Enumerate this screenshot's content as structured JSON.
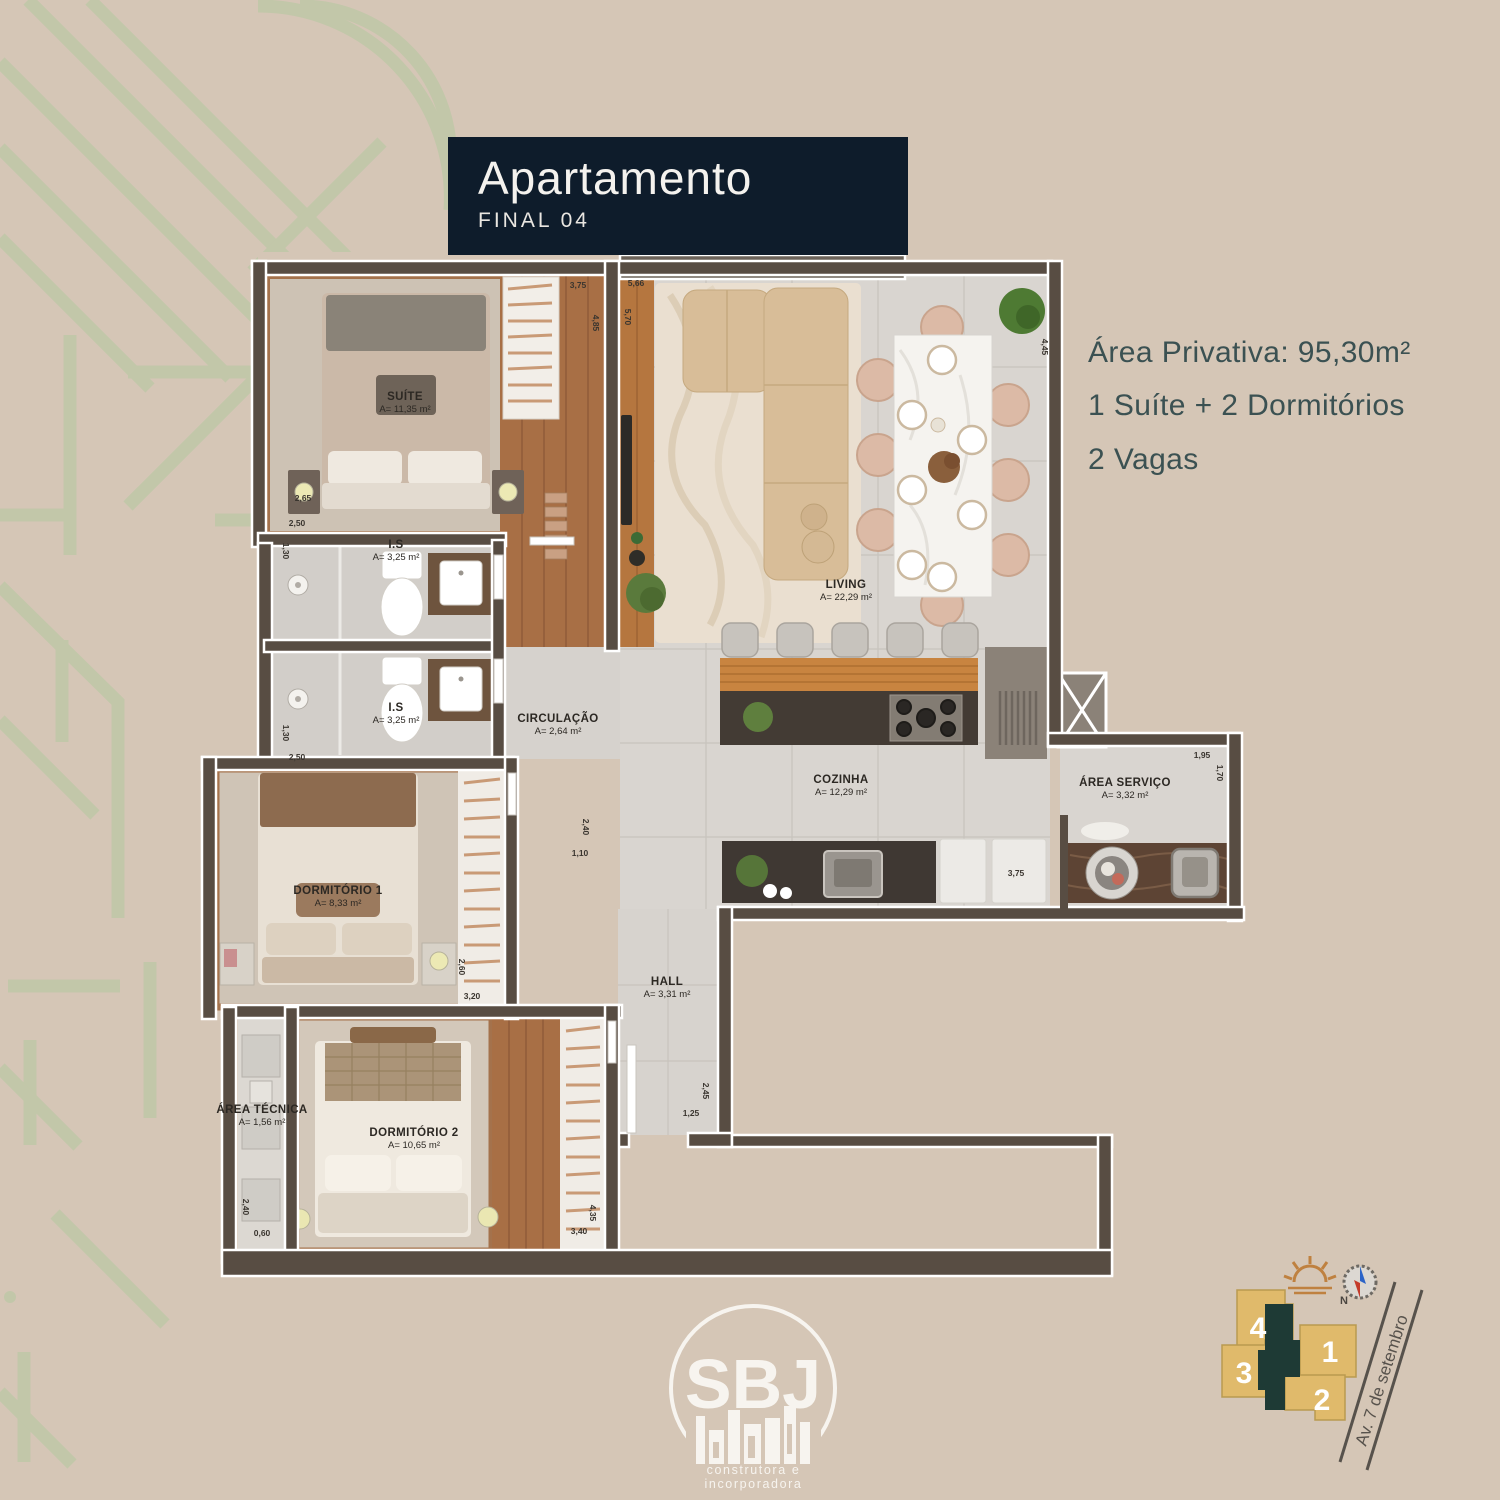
{
  "header": {
    "title": "Apartamento",
    "subtitle": "FINAL 04"
  },
  "specs": {
    "line1": "Área Privativa: 95,30m²",
    "line2": "1 Suíte + 2 Dormitórios",
    "line3": "2 Vagas"
  },
  "colors": {
    "background": "#d5c6b6",
    "pattern_green": "#b7c8a2",
    "header_navy": "#0e1c2b",
    "spec_text": "#3b5152",
    "wall": "#584d43",
    "wood": "#a86f45",
    "gold_block": "#e0ba6b",
    "core_teal": "#1e3a35"
  },
  "floorplan": {
    "rooms": [
      {
        "name": "SUÍTE",
        "area": "A= 11,35 m²",
        "x": 205,
        "y": 148
      },
      {
        "name": "I.S",
        "area": "A= 3,25 m²",
        "x": 196,
        "y": 296
      },
      {
        "name": "I.S",
        "area": "A= 3,25 m²",
        "x": 196,
        "y": 459
      },
      {
        "name": "CIRCULAÇÃO",
        "area": "A= 2,64 m²",
        "x": 358,
        "y": 470
      },
      {
        "name": "LIVING",
        "area": "A= 22,29 m²",
        "x": 646,
        "y": 336
      },
      {
        "name": "COZINHA",
        "area": "A= 12,29 m²",
        "x": 641,
        "y": 531
      },
      {
        "name": "ÁREA SERVIÇO",
        "area": "A= 3,32 m²",
        "x": 925,
        "y": 534
      },
      {
        "name": "DORMITÓRIO 1",
        "area": "A= 8,33 m²",
        "x": 138,
        "y": 642
      },
      {
        "name": "DORMITÓRIO 2",
        "area": "A= 10,65 m²",
        "x": 214,
        "y": 884
      },
      {
        "name": "ÁREA TÉCNICA",
        "area": "A= 1,56 m²",
        "x": 62,
        "y": 861
      },
      {
        "name": "HALL",
        "area": "A= 3,31 m²",
        "x": 467,
        "y": 733
      }
    ],
    "dimensions": [
      {
        "t": "3,75",
        "x": 378,
        "y": 30,
        "r": 0
      },
      {
        "t": "4,85",
        "x": 396,
        "y": 68,
        "r": 90
      },
      {
        "t": "5,66",
        "x": 436,
        "y": 28,
        "r": 0
      },
      {
        "t": "5,70",
        "x": 428,
        "y": 62,
        "r": 90
      },
      {
        "t": "4,45",
        "x": 845,
        "y": 92,
        "r": 90
      },
      {
        "t": "2,65",
        "x": 103,
        "y": 243,
        "r": 0
      },
      {
        "t": "2,50",
        "x": 97,
        "y": 268,
        "r": 0
      },
      {
        "t": "1,30",
        "x": 86,
        "y": 296,
        "r": 90
      },
      {
        "t": "1,30",
        "x": 86,
        "y": 478,
        "r": 90
      },
      {
        "t": "2,50",
        "x": 97,
        "y": 502,
        "r": 0
      },
      {
        "t": "1,95",
        "x": 1002,
        "y": 500,
        "r": 0
      },
      {
        "t": "1,70",
        "x": 1020,
        "y": 518,
        "r": 90
      },
      {
        "t": "3,75",
        "x": 816,
        "y": 618,
        "r": 0
      },
      {
        "t": "2,40",
        "x": 386,
        "y": 572,
        "r": 90
      },
      {
        "t": "1,10",
        "x": 380,
        "y": 598,
        "r": 0
      },
      {
        "t": "2,60",
        "x": 262,
        "y": 712,
        "r": 90
      },
      {
        "t": "3,20",
        "x": 272,
        "y": 741,
        "r": 0
      },
      {
        "t": "2,40",
        "x": 46,
        "y": 952,
        "r": 90
      },
      {
        "t": "0,60",
        "x": 62,
        "y": 978,
        "r": 0
      },
      {
        "t": "4,35",
        "x": 393,
        "y": 958,
        "r": 90
      },
      {
        "t": "3,40",
        "x": 379,
        "y": 976,
        "r": 0
      },
      {
        "t": "2,45",
        "x": 506,
        "y": 836,
        "r": 90
      },
      {
        "t": "1,25",
        "x": 491,
        "y": 858,
        "r": 0
      }
    ]
  },
  "logo": {
    "name": "SBJ",
    "tagline": "construtora e incorporadora"
  },
  "sitemap": {
    "unit1": "1",
    "unit2": "2",
    "unit3": "3",
    "unit4": "4",
    "street": "Av. 7 de setembro",
    "north_label": "N"
  }
}
